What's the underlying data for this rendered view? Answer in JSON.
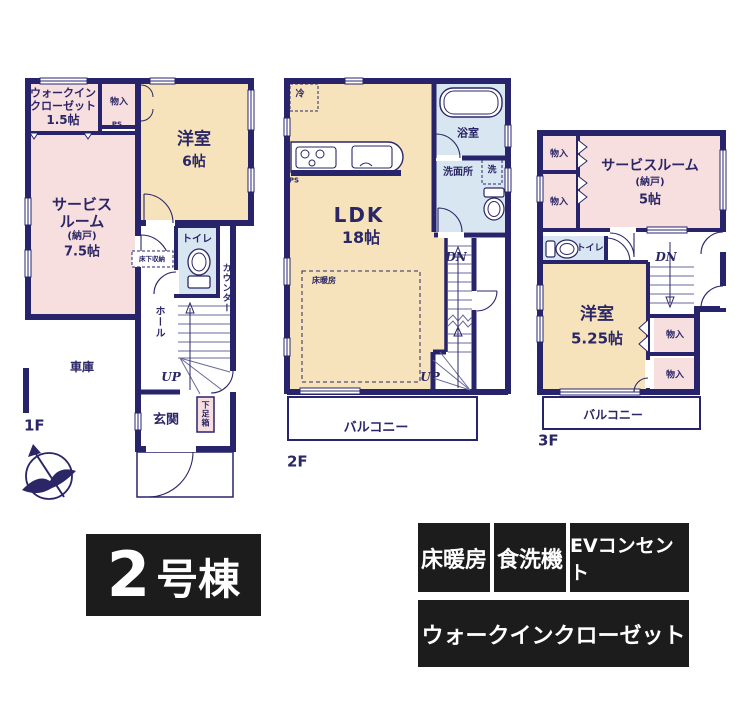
{
  "building": {
    "number": "2",
    "suffix": "号棟"
  },
  "features": [
    "床暖房",
    "食洗機",
    "EVコンセント",
    "ウォークインクローゼット"
  ],
  "f1": {
    "label": "1F",
    "wic_l1": "ウォークイン",
    "wic_l2": "クローゼット",
    "wic_size": "1.5帖",
    "closet": "物入",
    "ps": "PS",
    "west_name": "洋室",
    "west_size": "6帖",
    "sr_l1": "サービス",
    "sr_l2": "ルーム",
    "sr_l3": "(納戸)",
    "sr_size": "7.5帖",
    "underfloor": "床下収納",
    "toilet": "トイレ",
    "counter": "カウンター",
    "hall": "ホール",
    "up": "UP",
    "entrance": "玄関",
    "shoe_box": "下足箱",
    "garage": "車庫"
  },
  "f2": {
    "label": "2F",
    "fridge": "冷",
    "ps": "PS",
    "bath": "浴室",
    "wash_room": "洗面所",
    "washer": "洗",
    "ldk_name": "LDK",
    "ldk_size": "18帖",
    "floor_heating": "床暖房",
    "dn": "DN",
    "up": "UP",
    "balcony": "バルコニー"
  },
  "f3": {
    "label": "3F",
    "closet": "物入",
    "sr_l1": "サービスルーム",
    "sr_l2": "(納戸)",
    "sr_size": "5帖",
    "toilet": "トイレ",
    "dn": "DN",
    "west_name": "洋室",
    "west_size": "5.25帖",
    "balcony": "バルコニー"
  },
  "colors": {
    "wall": "#28246c",
    "text": "#2b2767",
    "room_beige": "#f7e3bb",
    "room_pink": "#f8dfdf",
    "room_blue": "#d7e6f0",
    "badge_black": "#1c1c1c"
  }
}
